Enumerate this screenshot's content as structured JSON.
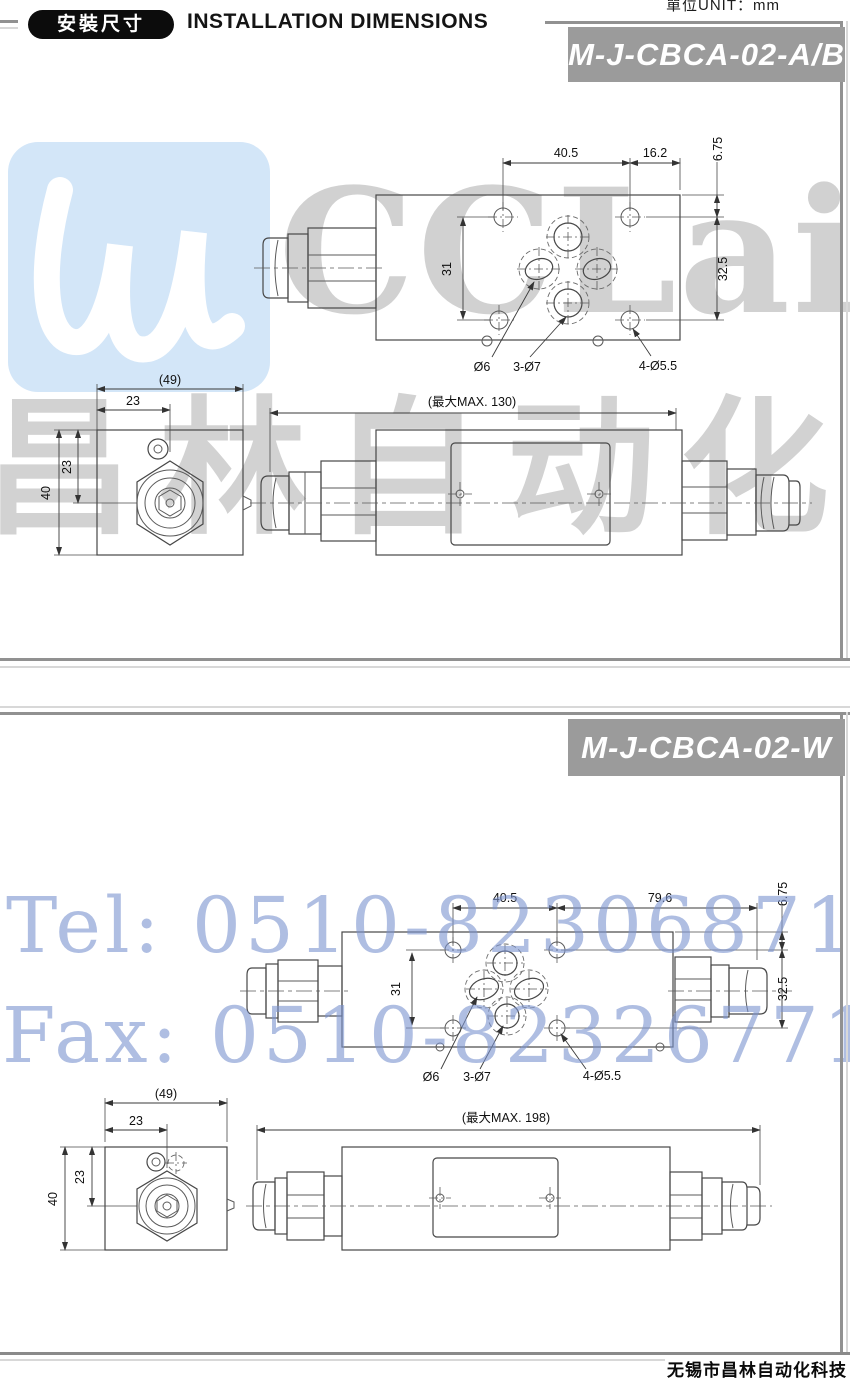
{
  "header": {
    "badge": "安裝尺寸",
    "title": "INSTALLATION DIMENSIONS",
    "unit": "單位UNIT：mm"
  },
  "watermarks": {
    "brand": "CCLair",
    "brand_cn": "昌林自动化",
    "tel": "Tel: 0510-82306871",
    "fax": "Fax: 0510-82326771",
    "logo_color": "#d3e6f8"
  },
  "footer": {
    "company": "无锡市昌林自动化科技"
  },
  "panel1": {
    "model": "M-J-CBCA-02-A/B",
    "top": {
      "w1": "40.5",
      "w2": "16.2",
      "edge": "6.75",
      "rows": "31",
      "col": "32.5",
      "port_center": "Ø6",
      "port_work": "3-Ø7",
      "port_mount": "4-Ø5.5"
    },
    "end": {
      "width": "(49)",
      "cx": "23",
      "cy": "23",
      "height": "40"
    },
    "side": {
      "max": "(最大MAX. 130)"
    }
  },
  "panel2": {
    "model": "M-J-CBCA-02-W",
    "top": {
      "w1": "40.5",
      "w2": "79.6",
      "edge": "6.75",
      "rows": "31",
      "col": "32.5",
      "port_center": "Ø6",
      "port_work": "3-Ø7",
      "port_mount": "4-Ø5.5"
    },
    "end": {
      "width": "(49)",
      "cx": "23",
      "cy": "23",
      "height": "40"
    },
    "side": {
      "max": "(最大MAX. 198)"
    }
  },
  "colors": {
    "model_bar_bg": "#9b9b9b",
    "panel_border": "#919191"
  }
}
